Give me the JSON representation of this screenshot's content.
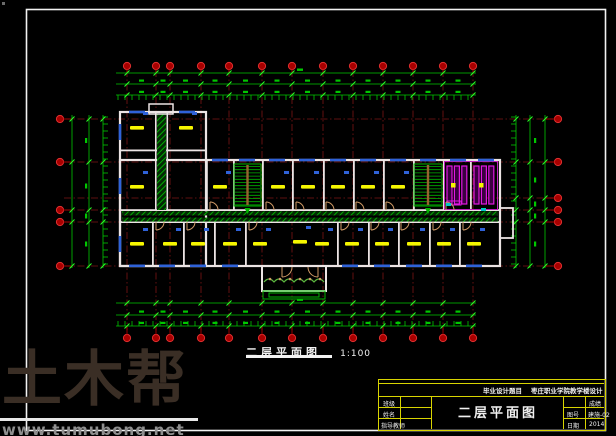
{
  "plan_title": {
    "text": "二层平面图",
    "scale_label": "1:100"
  },
  "title_block": {
    "header_label": "毕业设计题目",
    "header_value": "枣庄职业学院教学楼设计",
    "left_rows": [
      {
        "label": "班级",
        "value": ""
      },
      {
        "label": "姓名",
        "value": ""
      },
      {
        "label": "指导教师",
        "value": ""
      }
    ],
    "drawing_name": "二层平面图",
    "right_rows": [
      {
        "label": "",
        "value": "成绩"
      },
      {
        "label": "图号",
        "value": "建施-02"
      },
      {
        "label": "日期",
        "value": "2014"
      }
    ]
  },
  "watermark": {
    "brand": "土木帮",
    "url": "www.tumubong.net",
    "brand_color": "#3a2e25",
    "url_color": "#8f8f8f"
  },
  "colors": {
    "frame": "#f2f2f2",
    "grid_red": "#7d1414",
    "bubble_fill": "#a80000",
    "bubble_stroke": "#e03030",
    "dim_green": "#00c800",
    "tick_green": "#2aff2a",
    "wall": "#ece4e4",
    "window_blue": "#2f62d8",
    "door_tan": "#d09a66",
    "label_yellow": "#f6f600",
    "stair_green": "#00b400",
    "rail_brown": "#96642e",
    "stall_magenta": "#e018e0",
    "cyan": "#00c8c8",
    "plant_green": "#5cb63e"
  },
  "plan": {
    "frame": [
      26.5,
      9.5,
      579,
      421
    ],
    "grid": {
      "cols_x": [
        127,
        156,
        170,
        201,
        229,
        262,
        292,
        323,
        353,
        383,
        413,
        443,
        473
      ],
      "rows_y": [
        119,
        162,
        198,
        210,
        222,
        266
      ],
      "left_rows_y": [
        119,
        162,
        210,
        222,
        266
      ],
      "top_bubble_y": 66,
      "bottom_bubble_y": 338,
      "left_bubble_x": 60,
      "right_bubble_x": 558,
      "v_span": [
        70,
        330
      ],
      "h_span": [
        64,
        554
      ]
    },
    "dims": {
      "top_ys": [
        73,
        84,
        95
      ],
      "bottom_ys": [
        303,
        315,
        326
      ],
      "hx": [
        116,
        476
      ],
      "left_xs": [
        72,
        89,
        103
      ],
      "right_xs": [
        516,
        530,
        545
      ],
      "vy": [
        115,
        268
      ]
    },
    "walls": {
      "outer": [
        [
          120,
          112,
          86,
          154
        ],
        [
          120,
          160,
          380,
          106
        ]
      ],
      "hlines": [
        [
          120,
          209.2,
          380,
          1.8
        ],
        [
          120,
          221.2,
          380,
          1.8
        ],
        [
          120,
          149.5,
          86,
          1.8
        ]
      ],
      "north_x": [
        206,
        233,
        262,
        292,
        323,
        353,
        383,
        413,
        443,
        470
      ],
      "south_x": [
        152,
        183,
        214,
        245,
        337,
        368,
        398,
        429,
        459
      ],
      "strip": [
        155,
        112,
        11.5,
        99
      ]
    },
    "stairs": [
      [
        234,
        164,
        27,
        42
      ],
      [
        414,
        164,
        28,
        42
      ]
    ],
    "toilet": {
      "outline": [
        444.5,
        161.5,
        53,
        48
      ],
      "stall_groups": [
        447,
        474
      ],
      "fixtures": [
        [
          451,
          183
        ],
        [
          479,
          183
        ]
      ]
    },
    "windows": {
      "north_y": 158.7,
      "north_x": [
        220,
        247,
        277,
        307,
        338,
        368,
        398,
        428,
        458,
        486
      ],
      "wing_y": 110.7,
      "wing_x": [
        137,
        187
      ],
      "south_y": 264.5,
      "south_x": [
        137,
        167,
        198,
        230,
        350,
        382,
        414,
        444,
        474
      ],
      "west_x": 118.7,
      "west_y": [
        132,
        186,
        244
      ]
    },
    "labels": [
      [
        137,
        128
      ],
      [
        186,
        128
      ],
      [
        137,
        187
      ],
      [
        220,
        187
      ],
      [
        278,
        187
      ],
      [
        308,
        187
      ],
      [
        338,
        187
      ],
      [
        368,
        187
      ],
      [
        398,
        187
      ],
      [
        137,
        244
      ],
      [
        170,
        244
      ],
      [
        198,
        244
      ],
      [
        230,
        244
      ],
      [
        260,
        244
      ],
      [
        300,
        242
      ],
      [
        322,
        244
      ],
      [
        352,
        244
      ],
      [
        382,
        244
      ],
      [
        414,
        244
      ],
      [
        444,
        244
      ],
      [
        474,
        244
      ]
    ],
    "doors": {
      "north_x": [
        210,
        266,
        296,
        326,
        356,
        386,
        446
      ],
      "south_x": [
        156,
        187,
        249,
        341,
        371,
        401,
        433,
        463
      ]
    },
    "porch": {
      "rect": [
        262,
        266,
        64,
        25
      ],
      "steps": [
        [
          263,
          291,
          62,
          8
        ],
        [
          269,
          293,
          50,
          4
        ]
      ]
    },
    "balcony": [
      500,
      208,
      13,
      30
    ],
    "landing": [
      149,
      104,
      24,
      10
    ],
    "cyan_marks": [
      [
        446,
        203
      ],
      [
        481,
        208
      ]
    ],
    "artifact": [
      2,
      2
    ]
  }
}
